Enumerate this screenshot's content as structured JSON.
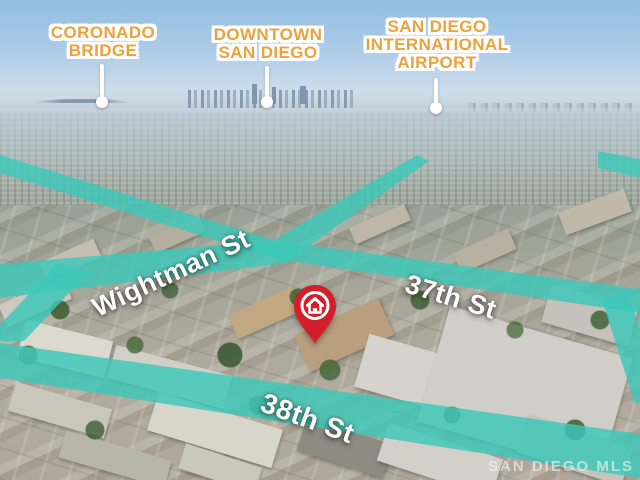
{
  "poi_labels": [
    {
      "name": "coronado-bridge-label",
      "lines": [
        "CORONADO",
        "BRIDGE"
      ]
    },
    {
      "name": "downtown-label",
      "lines": [
        "DOWNTOWN",
        "SAN DIEGO"
      ]
    },
    {
      "name": "airport-label",
      "lines": [
        "SAN DIEGO",
        "INTERNATIONAL",
        "AIRPORT"
      ]
    }
  ],
  "street_labels": [
    {
      "name": "wightman-street-label",
      "text": "Wightman St"
    },
    {
      "name": "37th-street-label",
      "text": "37th St"
    },
    {
      "name": "38th-street-label",
      "text": "38th St"
    }
  ],
  "marker": {
    "name": "property-pin",
    "icon": "house-icon",
    "color": "#d1202b"
  },
  "watermark": {
    "text": "SAN DIEGO MLS"
  },
  "colors": {
    "street_highlight": "#3cc8ba",
    "poi_label": "#eda13d",
    "street_label": "#ffffff",
    "leader_line": "#ffffff"
  }
}
